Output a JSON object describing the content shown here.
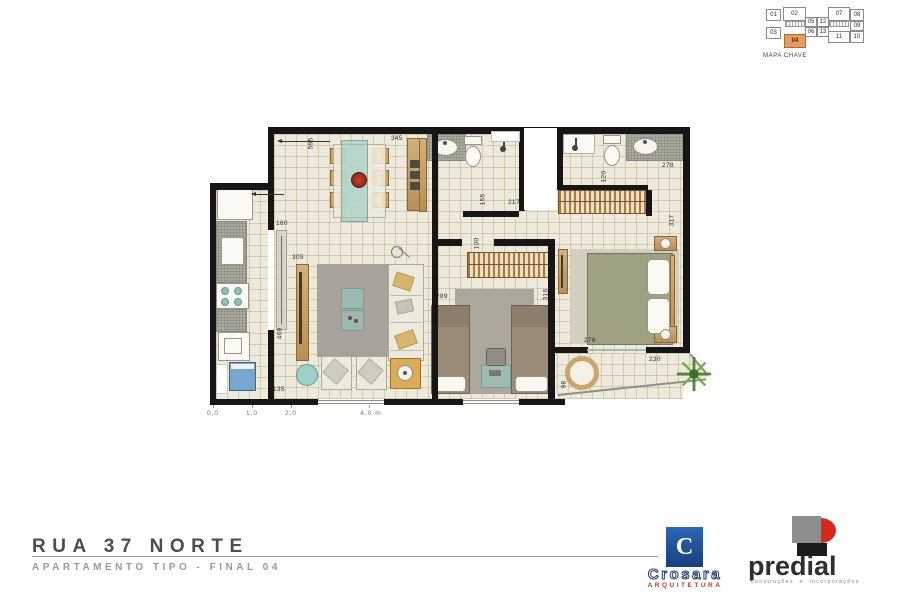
{
  "key_map": {
    "label": "MAPA CHAVE",
    "units": [
      "01",
      "02",
      "03",
      "04",
      "05",
      "12",
      "06",
      "13",
      "07",
      "08",
      "09",
      "10",
      "11"
    ],
    "highlighted_unit": "04",
    "highlight_color": "#E89B5E"
  },
  "floor_plan": {
    "dims": [
      "595",
      "345",
      "160",
      "305",
      "469",
      "135",
      "155",
      "217",
      "100",
      "120",
      "278",
      "317",
      "289",
      "316",
      "278",
      "230",
      "98"
    ],
    "scale_labels": [
      "0,0",
      "1,0",
      "2,0",
      "4,0 m"
    ]
  },
  "title_block": {
    "title": "RUA 37 NORTE",
    "subtitle": "APARTAMENTO TIPO - FINAL 04"
  },
  "logos": {
    "crosara": {
      "monogram": "C",
      "name": "Crosara",
      "tagline": "ARQUITETURA",
      "brand_blue": "#1E4F9C",
      "brand_red": "#C23B22"
    },
    "predial": {
      "name": "predial",
      "tagline": "construções e incorporações",
      "gray": "#8E8E8E",
      "red": "#D8281E",
      "black": "#1C1C1C"
    }
  }
}
